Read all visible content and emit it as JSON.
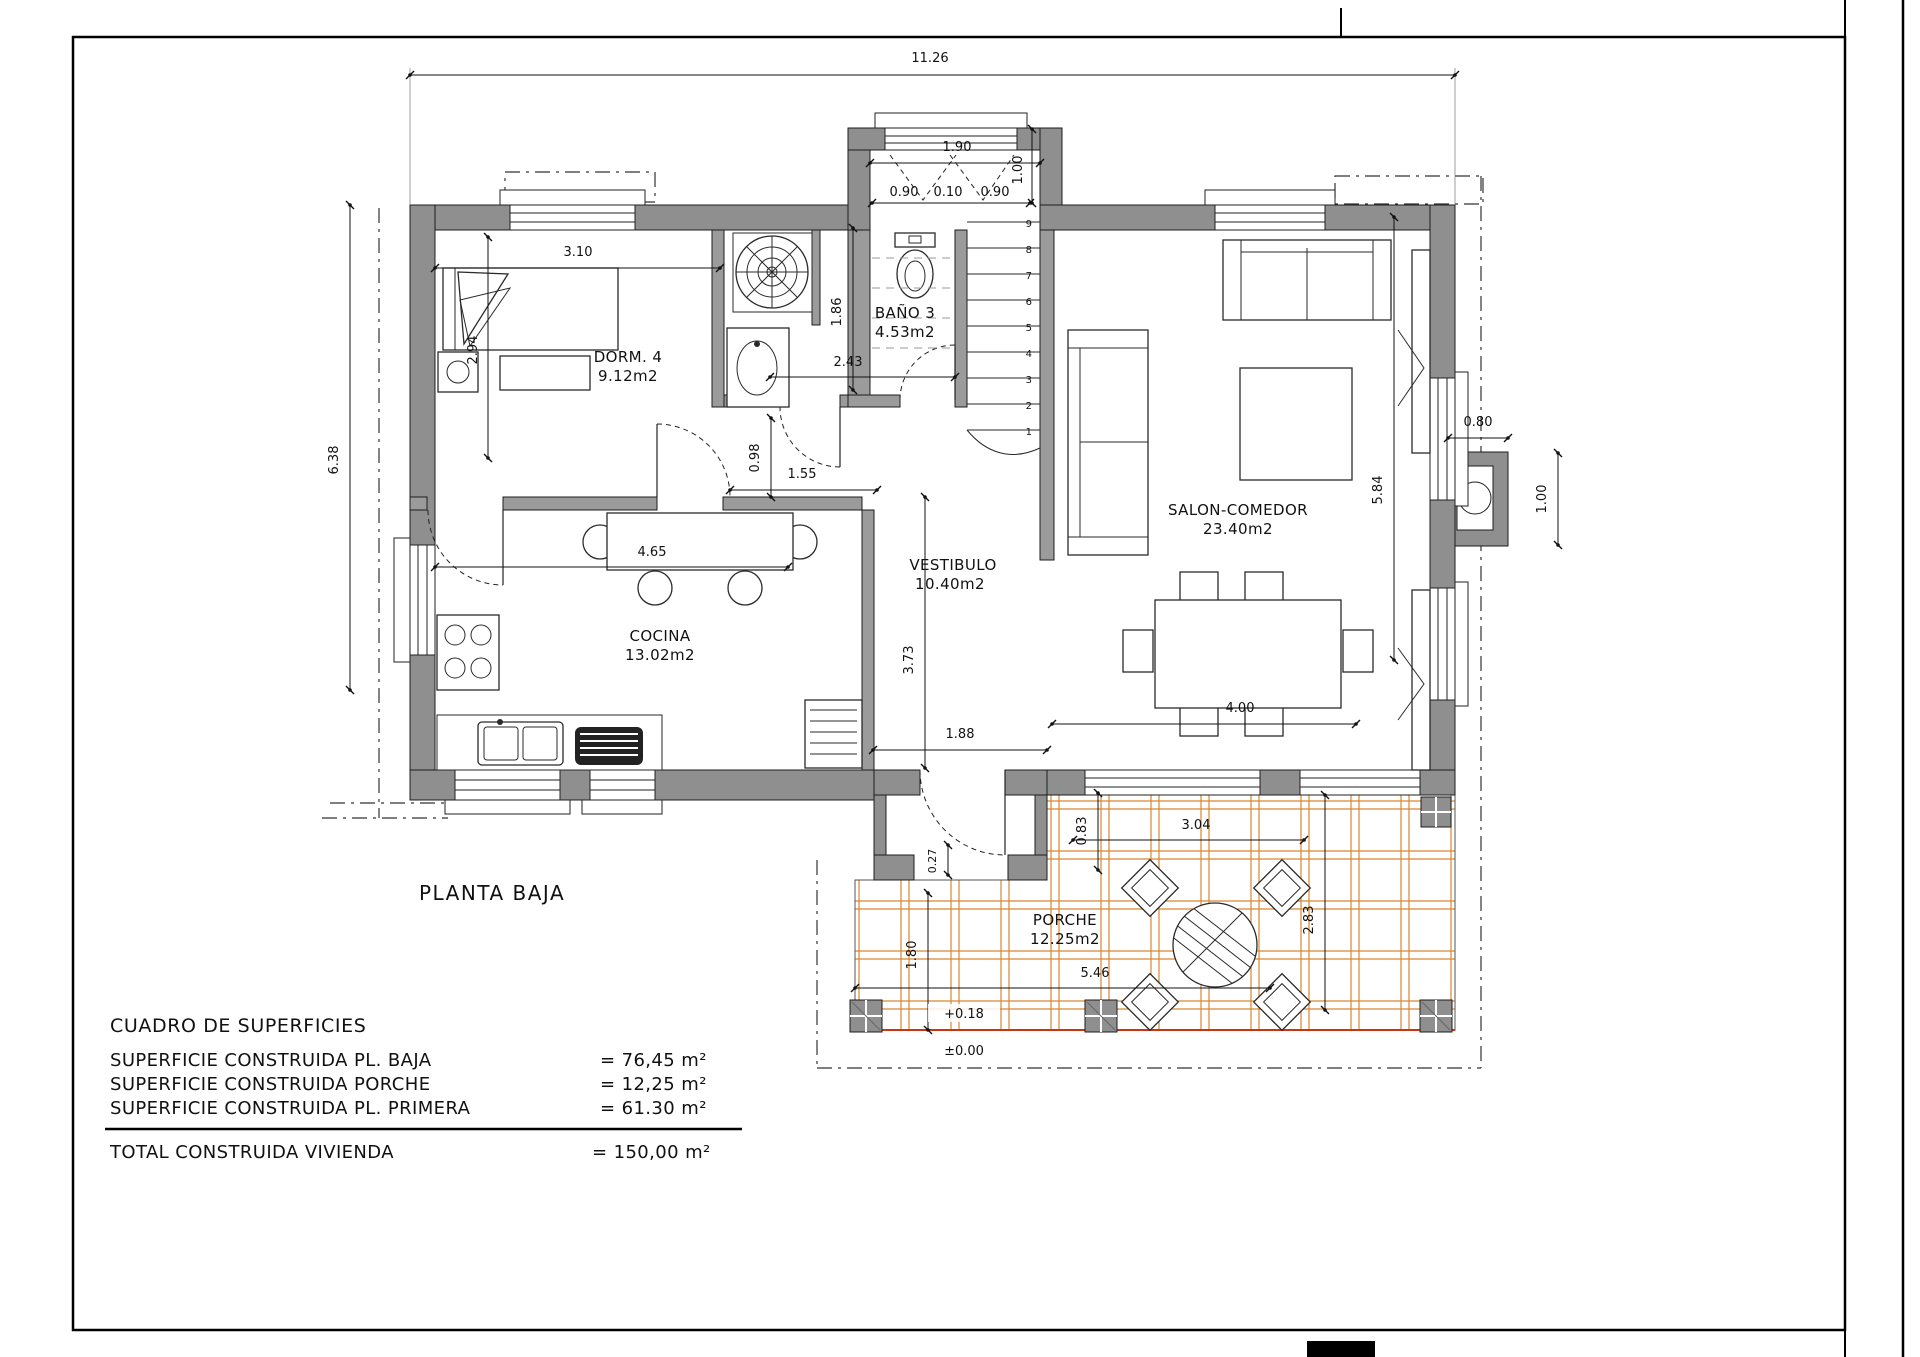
{
  "page": {
    "plan_title": "PLANTA BAJA"
  },
  "rooms": {
    "dorm": {
      "name": "DORM. 4",
      "area": "9.12m2"
    },
    "bano": {
      "name": "BAÑO 3",
      "area": "4.53m2"
    },
    "cocina": {
      "name": "COCINA",
      "area": "13.02m2"
    },
    "vestibulo": {
      "name": "VESTIBULO",
      "area": "10.40m2"
    },
    "salon": {
      "name": "SALON-COMEDOR",
      "area": "23.40m2"
    },
    "porche": {
      "name": "PORCHE",
      "area": "12.25m2"
    }
  },
  "dims": {
    "total_width": "11.26",
    "bump_width": "1.90",
    "bump_height": "1.00",
    "win_left": "0.90",
    "win_mid": "0.10",
    "win_right": "0.90",
    "dorm_width": "3.10",
    "dorm_depth": "2.94",
    "left_height": "6.38",
    "bath_height": "1.86",
    "bath_width": "2.43",
    "hall_depth": "0.98",
    "hall_width": "1.55",
    "kitchen_width": "4.65",
    "salon_height": "5.84",
    "chimney_width": "0.80",
    "chimney_height": "1.00",
    "vestibule_depth": "3.73",
    "entry_width": "1.88",
    "dining_width": "4.00",
    "entry_step": "0.27",
    "porch_notch": "0.83",
    "porch_bay": "3.04",
    "porch_depth": "2.83",
    "porch_left": "1.80",
    "porch_width": "5.46",
    "level_porch": "+0.18",
    "level_ground": "±0.00"
  },
  "stairs": {
    "steps": [
      "1",
      "2",
      "3",
      "4",
      "5",
      "6",
      "7",
      "8",
      "9"
    ]
  },
  "summary": {
    "title": "CUADRO DE SUPERFICIES",
    "rows": [
      {
        "label": "SUPERFICIE CONSTRUIDA PL. BAJA",
        "value": "= 76,45 m²"
      },
      {
        "label": "SUPERFICIE CONSTRUIDA PORCHE",
        "value": "=  12,25 m²"
      },
      {
        "label": "SUPERFICIE CONSTRUIDA PL. PRIMERA",
        "value": "=  61.30 m²"
      }
    ],
    "total": {
      "label": "TOTAL CONSTRUIDA VIVIENDA",
      "value": "= 150,00 m²"
    }
  },
  "colors": {
    "wall": "#8f8f8f",
    "tile": "#d9872f",
    "slab": "#cc3311",
    "line": "#1a1a1a"
  }
}
